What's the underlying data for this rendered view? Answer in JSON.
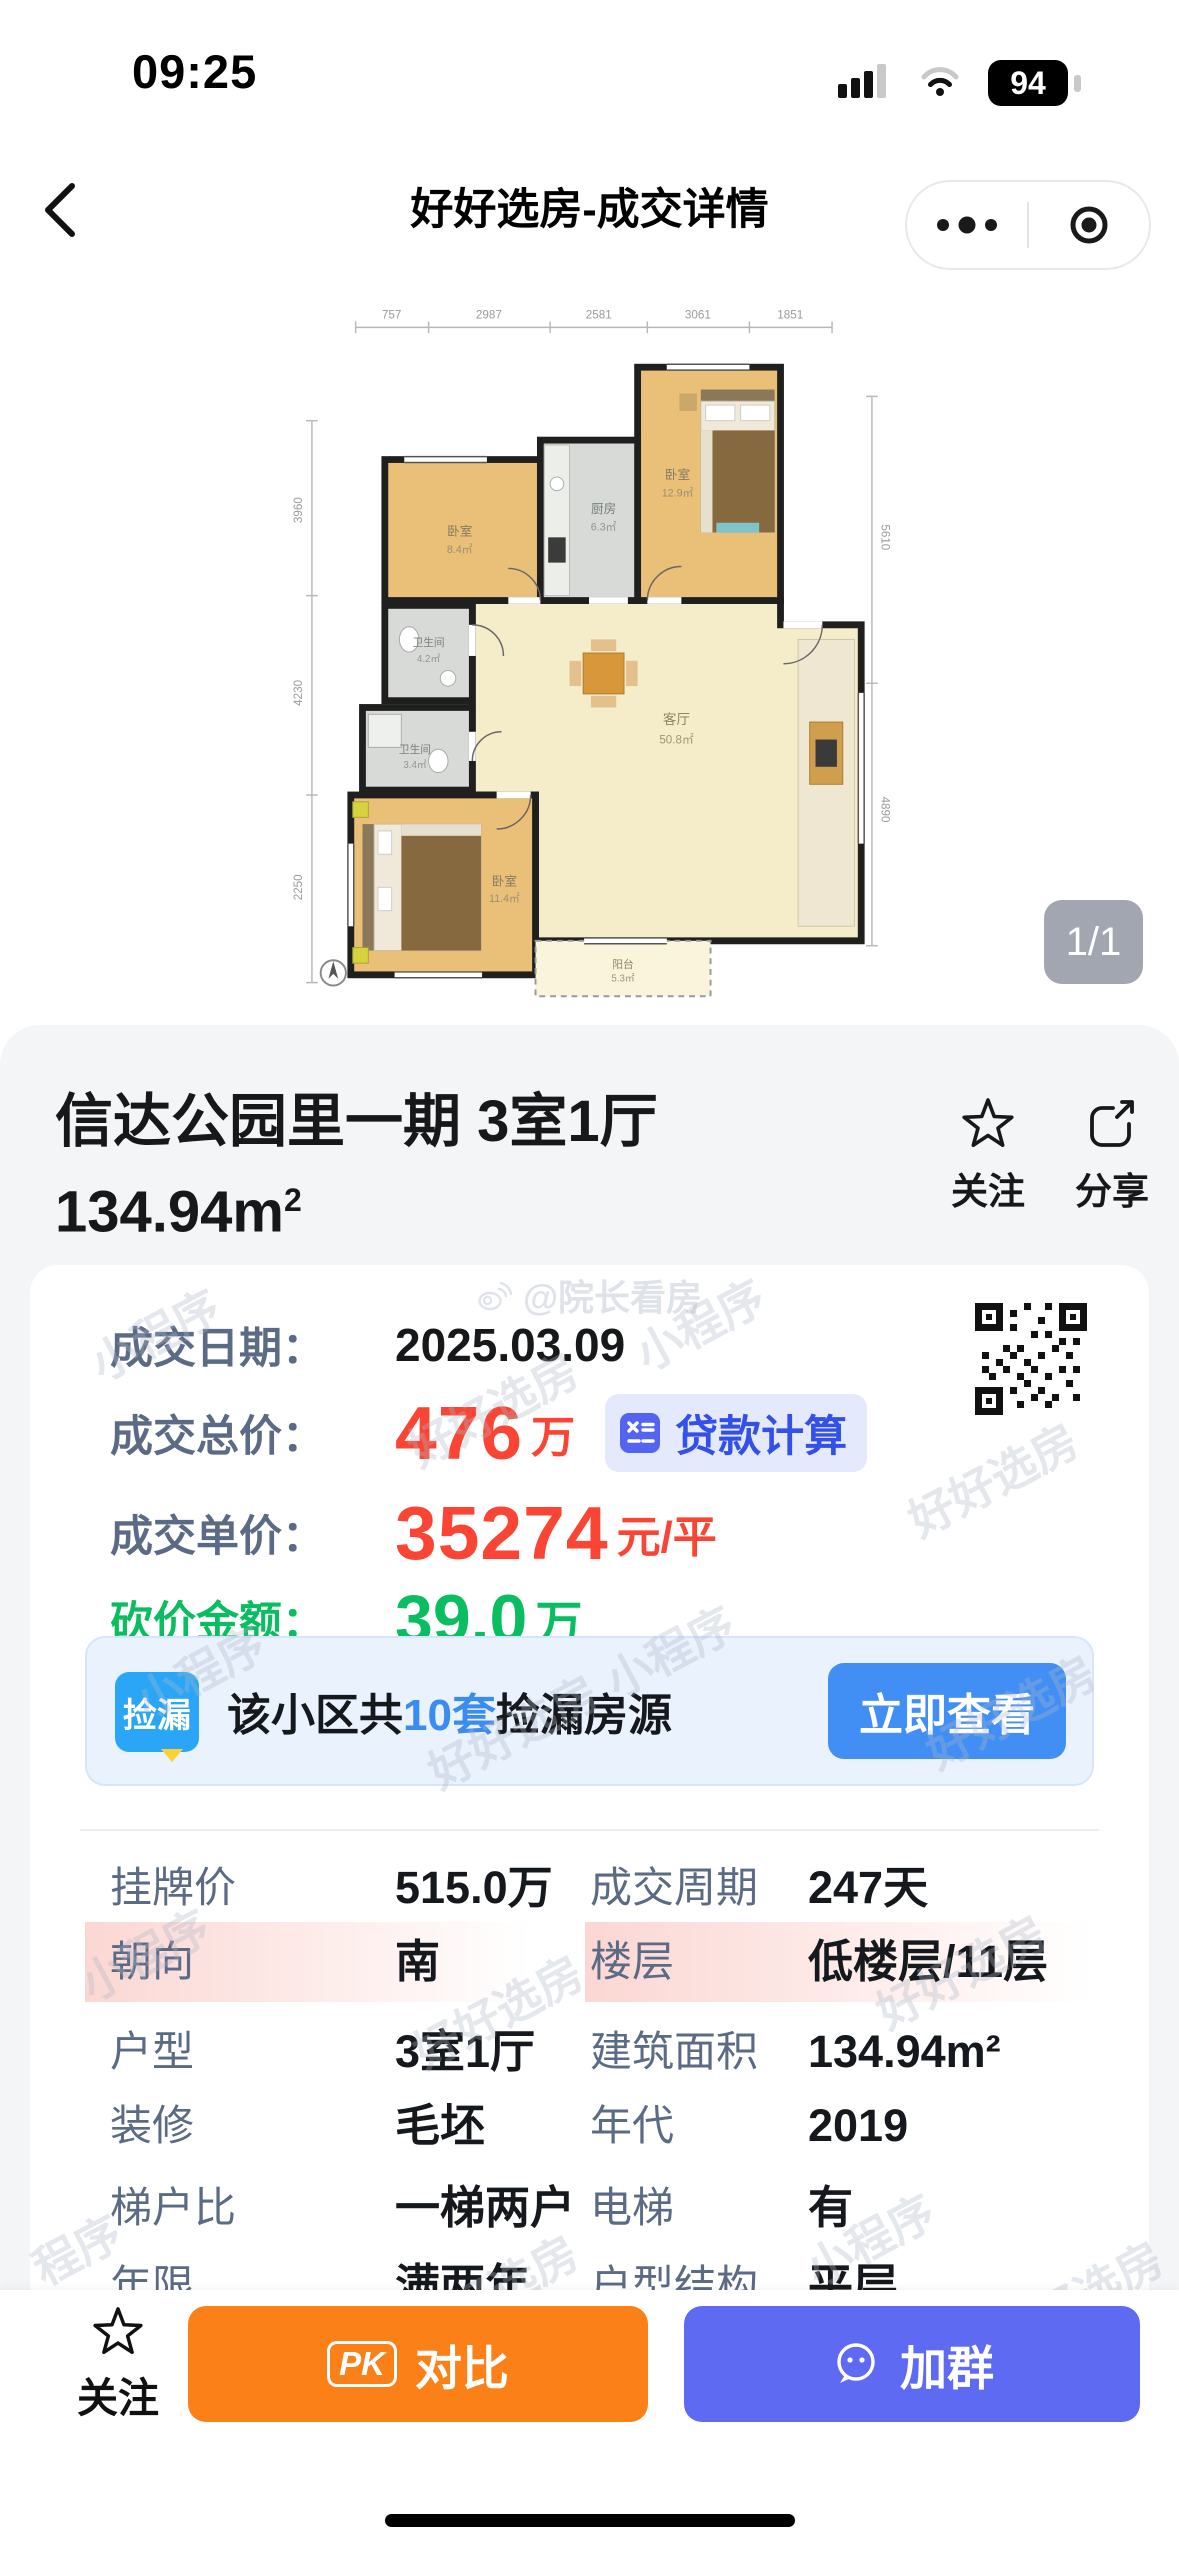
{
  "status_bar": {
    "time": "09:25",
    "battery_level": "94"
  },
  "nav_bar": {
    "title": "好好选房-成交详情"
  },
  "gallery": {
    "page_badge": "1/1"
  },
  "floorplan": {
    "rooms": {
      "bedroom_tr": {
        "name": "卧室",
        "area": "12.9㎡"
      },
      "bedroom_tl": {
        "name": "卧室",
        "area": "8.4㎡"
      },
      "kitchen": {
        "name": "厨房",
        "area": "6.3㎡"
      },
      "bath_upper": {
        "name": "卫生间",
        "area": "4.2㎡"
      },
      "bath_lower": {
        "name": "卫生间",
        "area": "3.4㎡"
      },
      "bedroom_master": {
        "name": "卧室",
        "area": "11.4㎡"
      },
      "living": {
        "name": "客厅",
        "area": "50.8㎡"
      },
      "balcony": {
        "name": "阳台",
        "area": "5.3㎡"
      }
    },
    "dims_top": [
      "757",
      "2987",
      "2581",
      "3061",
      "1851"
    ],
    "dims_left": [
      "3960",
      "4230",
      "2250"
    ],
    "dims_right": [
      "5610",
      "4890"
    ]
  },
  "listing": {
    "title": "信达公园里一期 3室1厅",
    "area": "134.94m",
    "area_sup": "2",
    "follow_label": "关注",
    "share_label": "分享",
    "credit": "@院长看房"
  },
  "deal": {
    "date_label": "成交日期：",
    "date_value": "2025.03.09",
    "total_label": "成交总价：",
    "total_value": "476",
    "total_unit": "万",
    "loan_calc_label": "贷款计算",
    "unit_label": "成交单价：",
    "unit_value": "35274",
    "unit_suffix": "元/平",
    "discount_label": "砍价金额：",
    "discount_value": "39.0",
    "discount_unit": "万"
  },
  "banner": {
    "badge": "捡漏",
    "prefix": "该小区共",
    "highlight": "10套",
    "suffix": "捡漏房源",
    "cta": "立即查看"
  },
  "details": {
    "rows": [
      {
        "l1": "挂牌价",
        "v1": "515.0万",
        "l2": "成交周期",
        "v2": "247天"
      },
      {
        "l1": "朝向",
        "v1": "南",
        "l2": "楼层",
        "v2": "低楼层/11层"
      },
      {
        "l1": "户型",
        "v1": "3室1厅",
        "l2": "建筑面积",
        "v2": "134.94m²"
      },
      {
        "l1": "装修",
        "v1": "毛坯",
        "l2": "年代",
        "v2": "2019"
      },
      {
        "l1": "梯户比",
        "v1": "一梯两户",
        "l2": "电梯",
        "v2": "有"
      },
      {
        "l1": "年限",
        "v1": "满两年",
        "l2": "户型结构",
        "v2": "平层"
      }
    ]
  },
  "bottom_bar": {
    "follow_label": "关注",
    "compare_icon_text": "PK",
    "compare_label": "对比",
    "join_label": "加群"
  },
  "watermarks": {
    "items": [
      "小程序",
      "好好选房",
      "小程序",
      "好好选房",
      "小程序",
      "好好选房",
      "小程序",
      "好好选房",
      "小程序",
      "好好选房",
      "好好选房",
      "程序",
      "好好选房",
      "小程序",
      "好好选房"
    ]
  },
  "colors": {
    "price_red": "#fa4535",
    "discount_green": "#0bbd61",
    "loan_blue": "#3350e8",
    "banner_cta_blue": "#418ef5",
    "badge_blue": "#2ba6f7",
    "highlight_blue": "#3b8cf0",
    "compare_orange": "#fb8017",
    "join_blue": "#5d6af1",
    "row_highlight_pink": "#fbd7d3"
  }
}
